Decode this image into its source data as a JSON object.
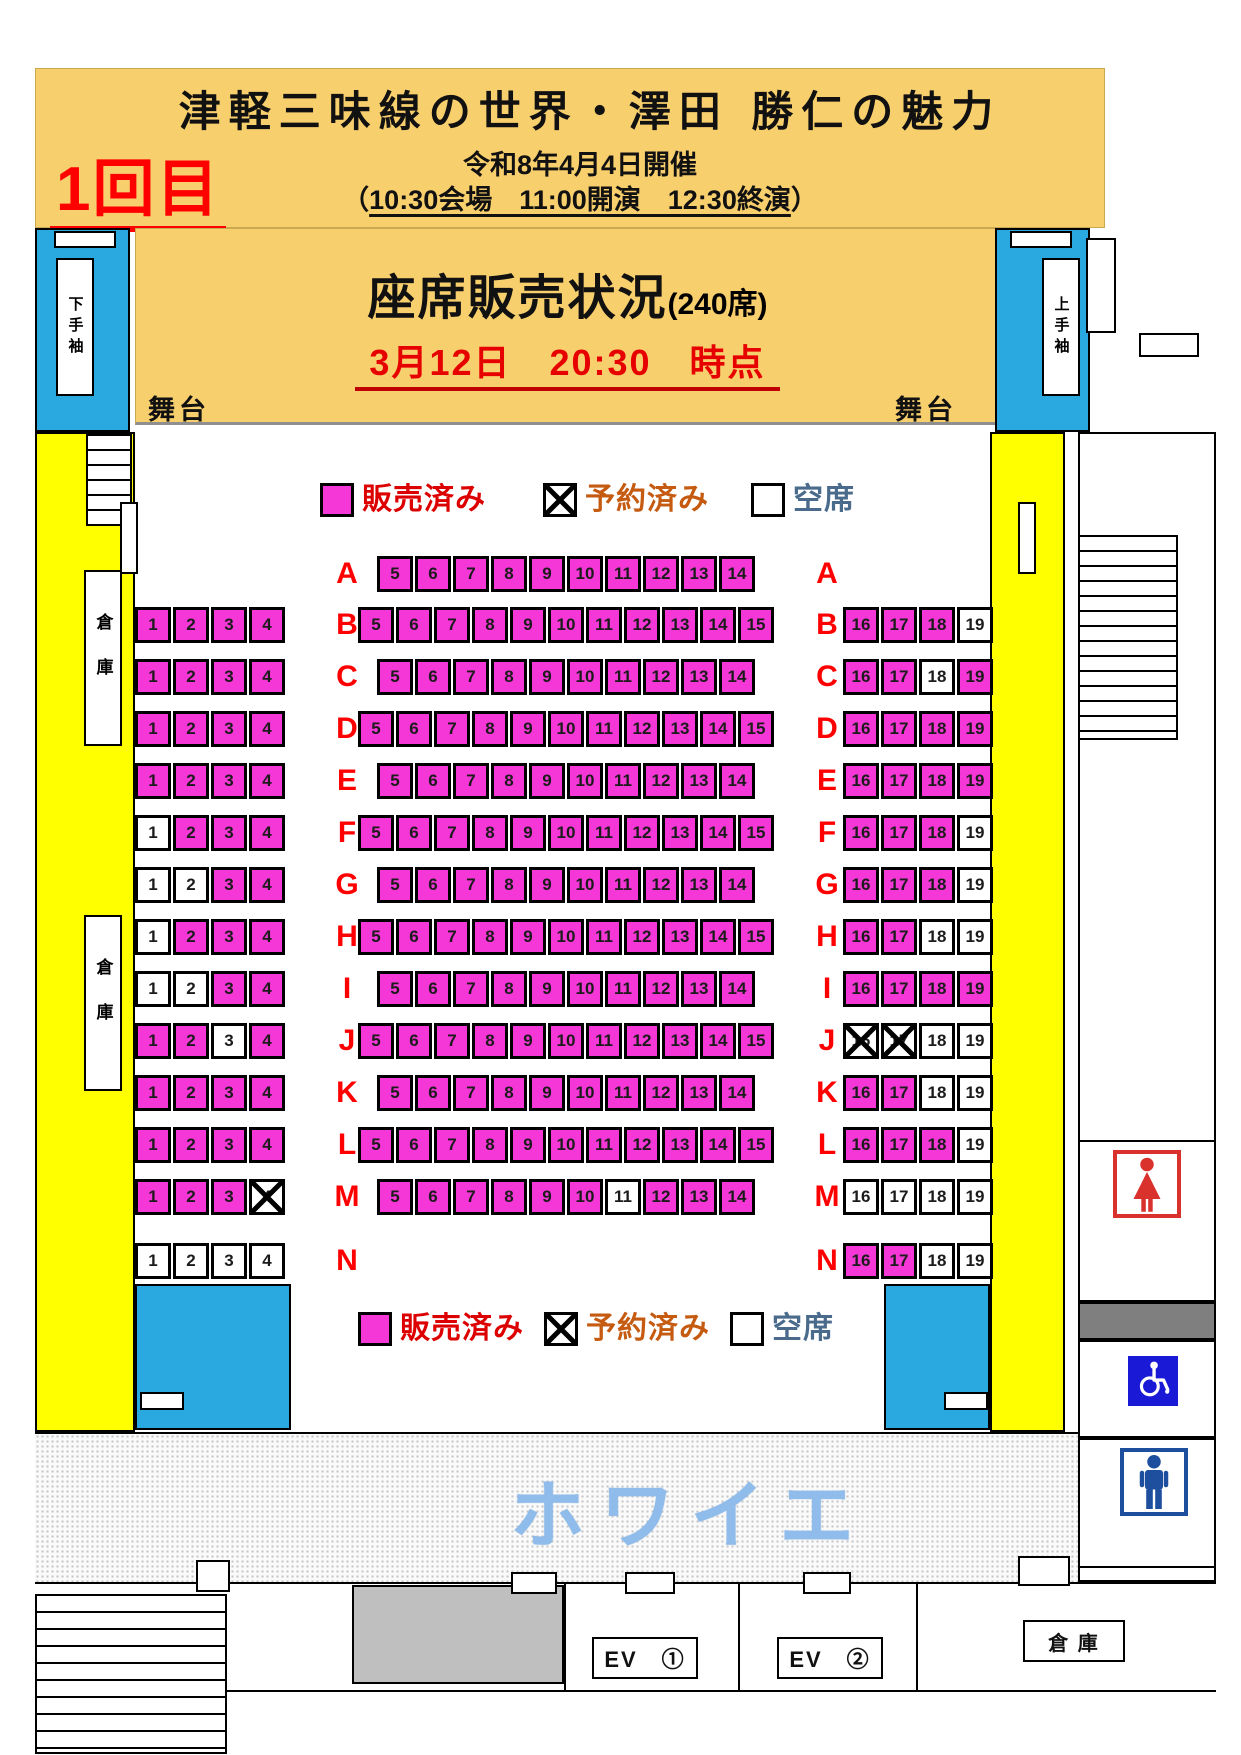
{
  "header": {
    "session_label": "1回目",
    "title": "津軽三味線の世界・澤田 勝仁の魅力",
    "date_line": "令和8年4月4日開催",
    "time_paren_open": "（",
    "time_line": "10:30会場　11:00開演　12:30終演",
    "time_paren_close": "）"
  },
  "status_panel": {
    "title": "座席販売状況",
    "capacity": "(240席)",
    "as_of": "3月12日　20:30　時点",
    "stage_label_left": "舞台",
    "stage_label_right": "舞台"
  },
  "legend": {
    "sold": "販売済み",
    "reserved": "予約済み",
    "vacant": "空席"
  },
  "venue": {
    "wing_left": "下手袖",
    "wing_right": "上手袖",
    "storage_side_upper": "倉庫",
    "storage_side_lower": "倉庫",
    "foyer": "ホワイエ",
    "elevator_1": "EV　①",
    "elevator_2": "EV　②",
    "storage_bottom": "倉 庫"
  },
  "colors": {
    "header_gold": "#F8CF6D",
    "seat_sold_magenta": "#F637D7",
    "wing_cyan": "#29A9E0",
    "band_yellow": "#FFFF00",
    "row_letter_red": "#FF0000",
    "legend_sold_text": "#DD0000",
    "legend_reserved_text": "#C55A11",
    "legend_vacant_text": "#4A6B8C",
    "foyer_text_blue": "#8FBCEA",
    "accessible_blue": "#1A1AD6",
    "mens_navy": "#1D4F9E",
    "womens_red": "#D9312B"
  },
  "seating": {
    "status_codes": {
      "S": "販売済み (sold)",
      "R": "予約済み (reserved)",
      "V": "空席 (vacant)"
    },
    "rows": [
      {
        "row": "A",
        "left": null,
        "center": {
          "start": 5,
          "status": "SSSSSSSSSS"
        },
        "right": null
      },
      {
        "row": "B",
        "left": "SSSS",
        "center": {
          "start": 5,
          "status": "SSSSSSSSSSS"
        },
        "right": "SSSV"
      },
      {
        "row": "C",
        "left": "SSSS",
        "center": {
          "start": 5,
          "status": "SSSSSSSSSS"
        },
        "right": "SSVS"
      },
      {
        "row": "D",
        "left": "SSSS",
        "center": {
          "start": 5,
          "status": "SSSSSSSSSSS"
        },
        "right": "SSSS"
      },
      {
        "row": "E",
        "left": "SSSS",
        "center": {
          "start": 5,
          "status": "SSSSSSSSSS"
        },
        "right": "SSSS"
      },
      {
        "row": "F",
        "left": "VSSS",
        "center": {
          "start": 5,
          "status": "SSSSSSSSSSS"
        },
        "right": "SSSV"
      },
      {
        "row": "G",
        "left": "VVSS",
        "center": {
          "start": 5,
          "status": "SSSSSSSSSS"
        },
        "right": "SSSV"
      },
      {
        "row": "H",
        "left": "VSSS",
        "center": {
          "start": 5,
          "status": "SSSSSSSSSSS"
        },
        "right": "SSVV"
      },
      {
        "row": "I",
        "left": "VVSS",
        "center": {
          "start": 5,
          "status": "SSSSSSSSSS"
        },
        "right": "SSSS"
      },
      {
        "row": "J",
        "left": "SSVS",
        "center": {
          "start": 5,
          "status": "SSSSSSSSSSS"
        },
        "right": "RRVV"
      },
      {
        "row": "K",
        "left": "SSSS",
        "center": {
          "start": 5,
          "status": "SSSSSSSSSS"
        },
        "right": "SSVV"
      },
      {
        "row": "L",
        "left": "SSSS",
        "center": {
          "start": 5,
          "status": "SSSSSSSSSSS"
        },
        "right": "SSSV"
      },
      {
        "row": "M",
        "left": "SSSR",
        "center": {
          "start": 5,
          "status": "SSSSSSVSSS"
        },
        "right": "VVVV"
      },
      {
        "row": "N",
        "left": "VVVV",
        "center": null,
        "right": "SSVV"
      }
    ]
  }
}
